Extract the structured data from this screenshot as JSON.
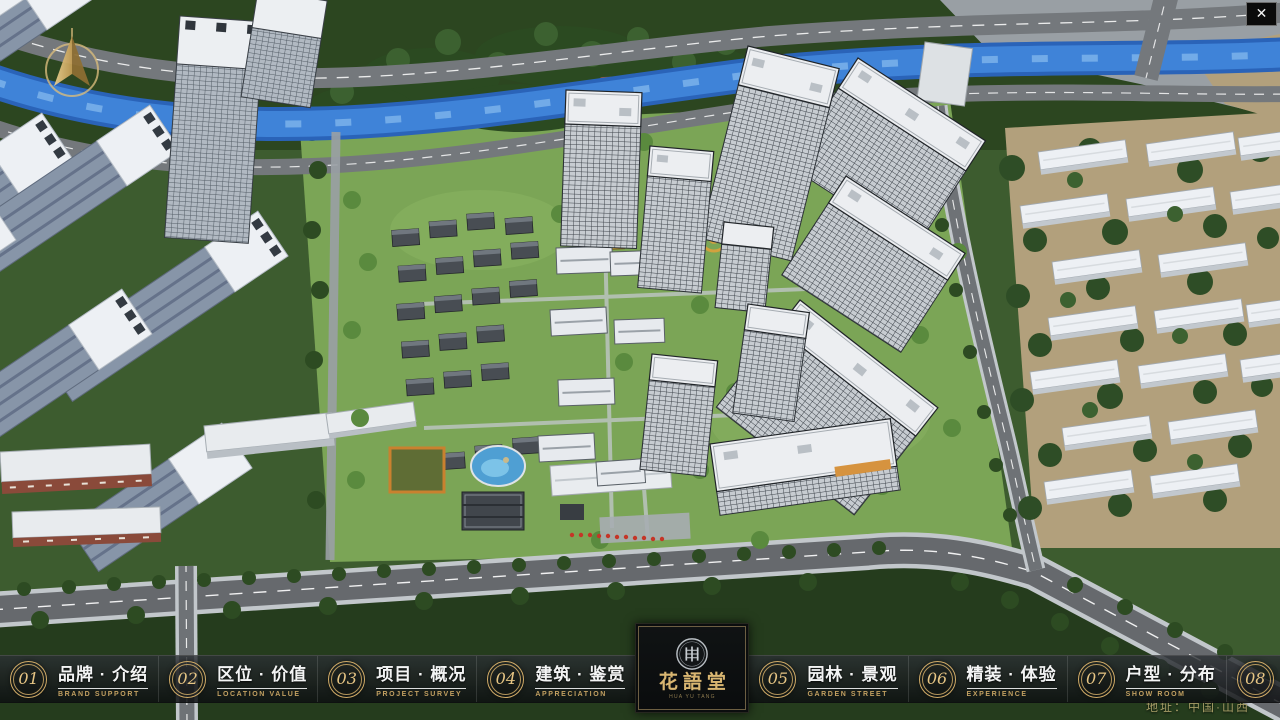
{
  "ui": {
    "close_glyph": "✕",
    "address": "地址：中国·山西"
  },
  "logo": {
    "title": "花語堂",
    "subtitle": "HUA YU TANG"
  },
  "nav": {
    "items": [
      {
        "num": "01",
        "label": "品牌 · 介绍",
        "sub": "BRAND SUPPORT"
      },
      {
        "num": "02",
        "label": "区位 · 价值",
        "sub": "LOCATION VALUE"
      },
      {
        "num": "03",
        "label": "项目 · 概况",
        "sub": "PROJECT SURVEY"
      },
      {
        "num": "04",
        "label": "建筑 · 鉴赏",
        "sub": "APPRECIATION"
      },
      {
        "num": "05",
        "label": "园林 · 景观",
        "sub": "GARDEN STREET"
      },
      {
        "num": "06",
        "label": "精装 · 体验",
        "sub": "EXPERIENCE"
      },
      {
        "num": "07",
        "label": "户型 · 分布",
        "sub": "SHOW ROOM"
      },
      {
        "num": "08",
        "label": "一房 · 一景",
        "sub": "COMMUNITY"
      }
    ]
  },
  "colors": {
    "accent_gold": "#d0ab67",
    "bar_background": "rgba(16,19,21,0.80)",
    "river_blue": "#3f83d8",
    "lawn_green": "#7ba556",
    "road_gray": "#6e7276",
    "roof_white": "#eceef1"
  }
}
